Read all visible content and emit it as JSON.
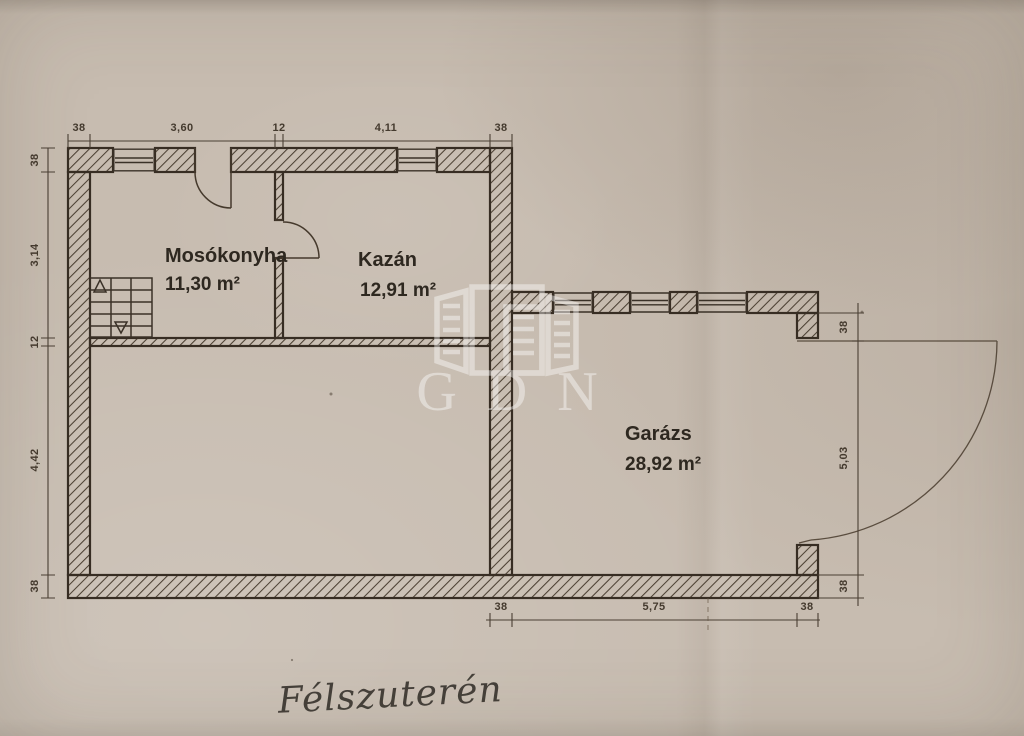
{
  "meta": {
    "handwritten_caption": "Félszuterén",
    "watermark": "GDN"
  },
  "rooms": {
    "mosokonyha": {
      "name": "Mosókonyha",
      "area": "11,30 m²"
    },
    "kazan": {
      "name": "Kazán",
      "area": "12,91 m²"
    },
    "garazs": {
      "name": "Garázs",
      "area": "28,92 m²"
    }
  },
  "dimensions": {
    "top": [
      "38",
      "3,60",
      "12",
      "4,11",
      "38"
    ],
    "left": [
      "38",
      "3,14",
      "12",
      "4,42",
      "38"
    ],
    "right": [
      "38",
      "5,03",
      "38"
    ],
    "bottom": [
      "38",
      "5,75",
      "38"
    ]
  },
  "colors": {
    "paper": "#c7bcb0",
    "ink": "#3a3127",
    "dimension_ink": "#4a3f33",
    "watermark": "#ffffff"
  }
}
